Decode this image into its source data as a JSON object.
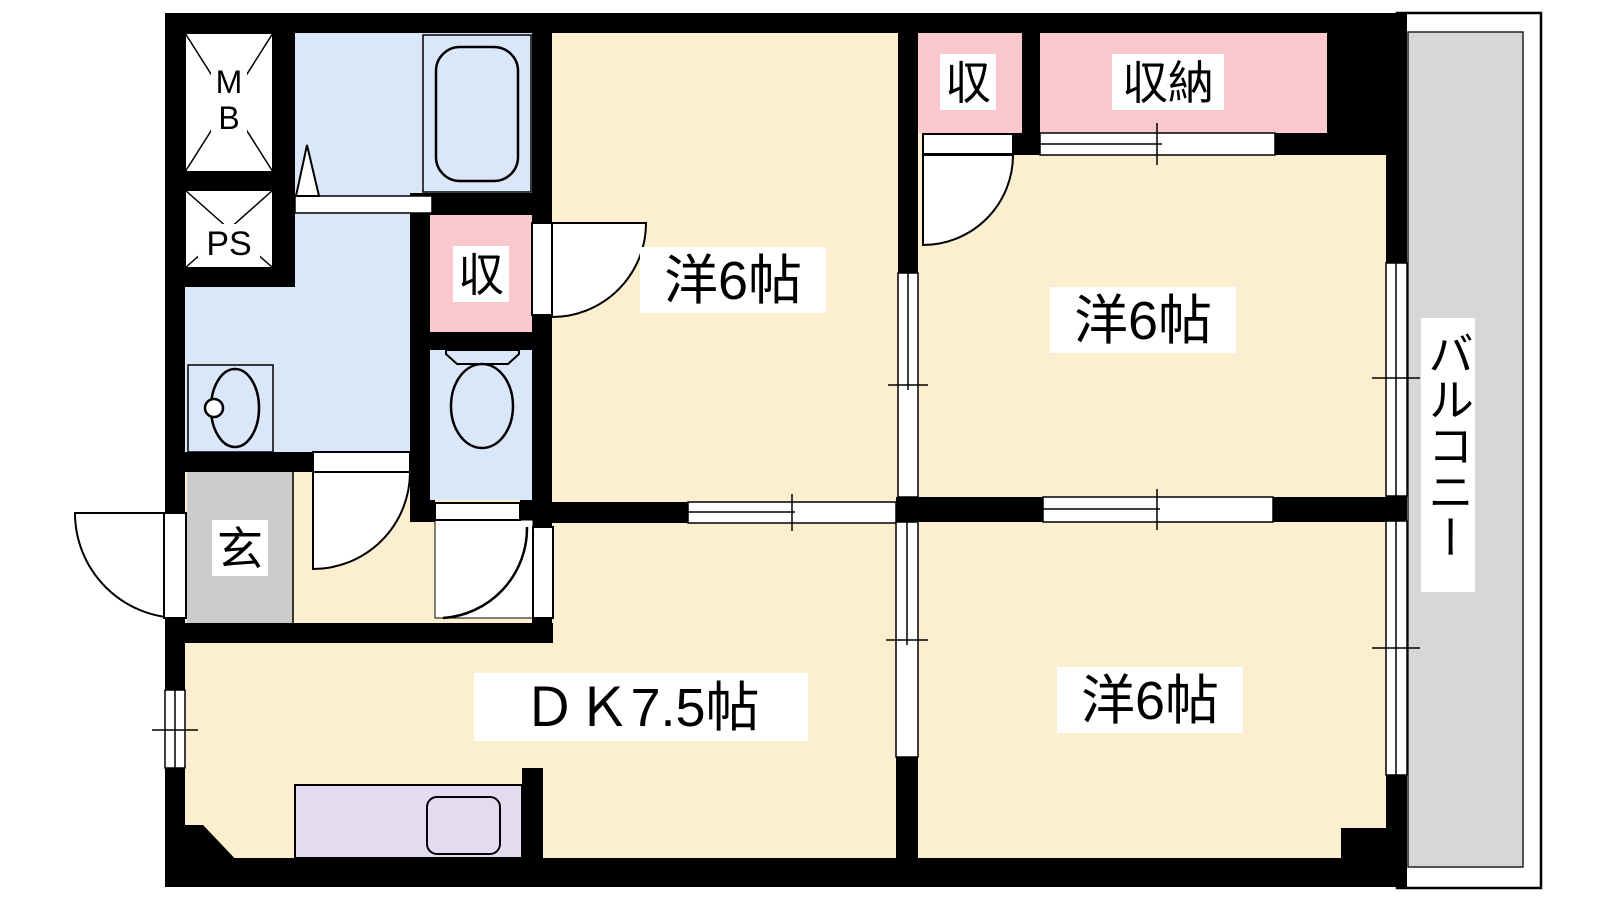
{
  "floorplan": {
    "type": "apartment-floorplan-2DK",
    "rooms": {
      "dining_kitchen": {
        "label": "ＤＫ7.5帖"
      },
      "western_top_center": {
        "label": "洋6帖"
      },
      "western_top_right": {
        "label": "洋6帖"
      },
      "western_bottom_right": {
        "label": "洋6帖"
      },
      "balcony": {
        "label": "バルコニー"
      },
      "entrance": {
        "label": "玄"
      },
      "closet_hallway": {
        "label": "収"
      },
      "closet_top_right_small": {
        "label": "収"
      },
      "closet_top_right_large": {
        "label": "収納"
      },
      "meter_box": {
        "label": "MB"
      },
      "pipe_shaft": {
        "label": "PS"
      }
    },
    "colors": {
      "wall": "#000000",
      "room_floor": "#FBEFD0",
      "wet_area_floor": "#DAE7F8",
      "closet_fill": "#F9C9CD",
      "entrance_floor": "#CBCBCB",
      "kitchen_counter": "#E5DBF1",
      "balcony_floor": "#D7D7D7",
      "paper": "#FFFFFF"
    }
  }
}
